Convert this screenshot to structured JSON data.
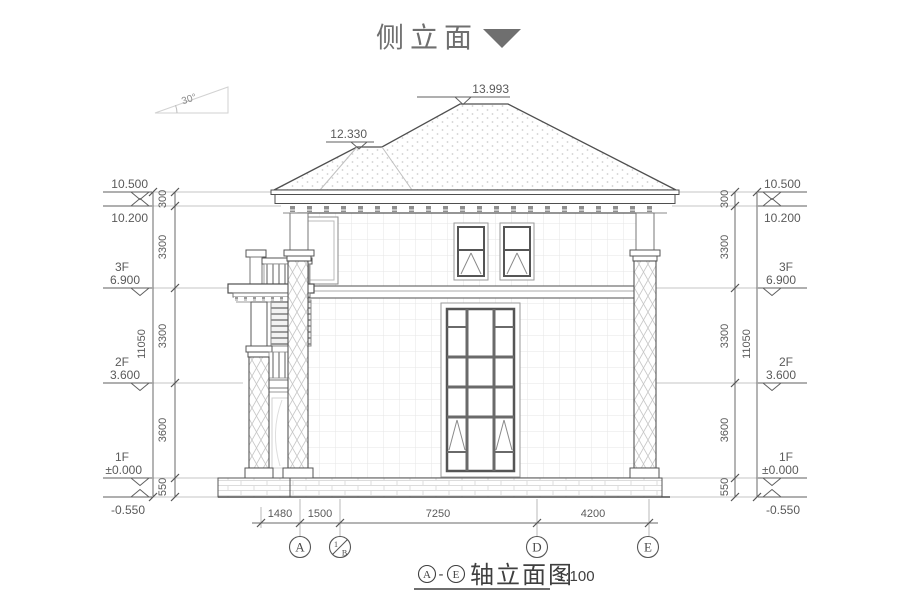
{
  "colors": {
    "ink": "#4f4f4f",
    "title_gray": "#6f6f6f",
    "texture": "#d9d9d9"
  },
  "header": {
    "title": "侧立面",
    "marker_icon": "triangle-down"
  },
  "roof": {
    "peak_elevation": "13.993",
    "left_ridge_elevation": "12.330",
    "slope_angle": "30°"
  },
  "levels": {
    "eave_top": {
      "elevation": "10.500"
    },
    "eave_bottom": {
      "elevation": "10.200"
    },
    "f3": {
      "floor": "3F",
      "elevation": "6.900"
    },
    "f2": {
      "floor": "2F",
      "elevation": "3.600"
    },
    "f1": {
      "floor": "1F",
      "elevation": "±0.000"
    },
    "ground": {
      "elevation": "-0.550"
    }
  },
  "vertical_dims": {
    "parapet": "300",
    "floor3": "3300",
    "floor2": "3300",
    "floor1": "3600",
    "plinth": "550",
    "overall": "11050"
  },
  "horizontal_dims": {
    "seg1": "1480",
    "seg2": "1500",
    "seg3": "7250",
    "seg4": "4200"
  },
  "axes": {
    "a": "A",
    "b1_top": "1",
    "b1_bottom": "B",
    "d": "D",
    "e": "E"
  },
  "footer": {
    "axis_from": "A",
    "dash": "-",
    "axis_to": "E",
    "title": "轴立面图",
    "scale": "1:100"
  }
}
